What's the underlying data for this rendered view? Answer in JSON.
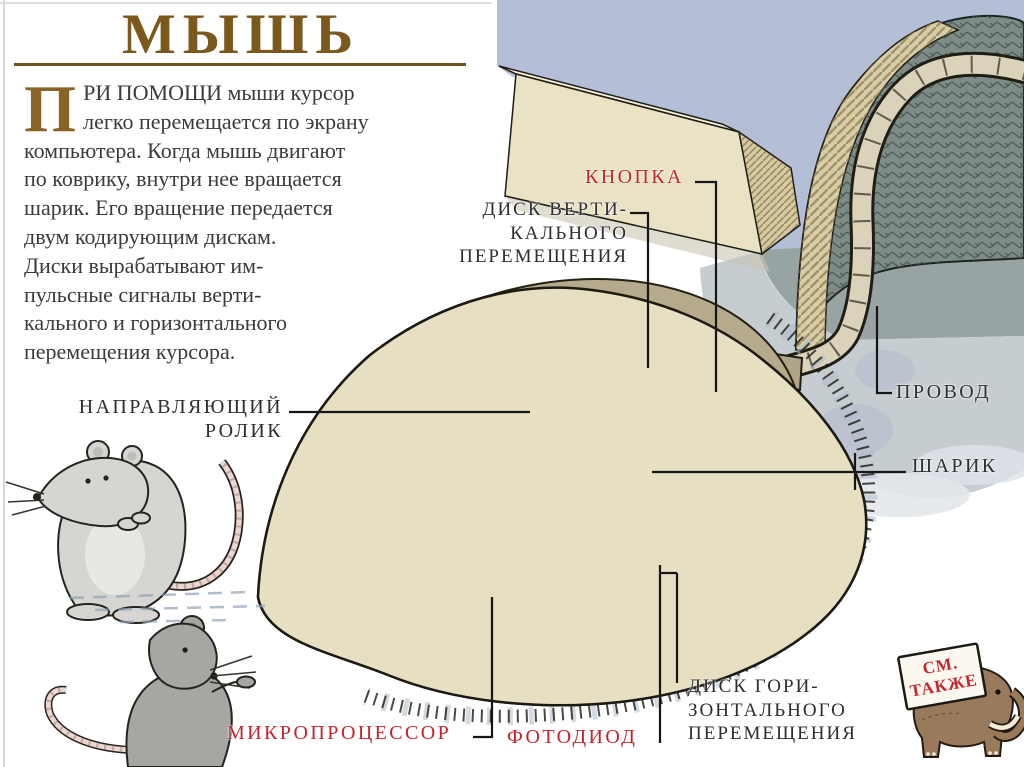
{
  "page": {
    "title": "МЫШЬ"
  },
  "intro": {
    "drop_cap": "П",
    "lines": [
      "РИ ПОМОЩИ мыши курсор",
      "легко перемещается по экрану",
      "компьютера. Когда мышь двигают",
      "по коврику, внутри нее вращается",
      "шарик. Его вращение передается",
      "двум кодирующим дискам.",
      "Диски вырабатывают им-",
      "пульсные сигналы верти-",
      "кального и горизонтального",
      "перемещения курсора."
    ]
  },
  "labels": {
    "button": "КНОПКА",
    "vertical_disk": [
      "ДИСК ВЕРТИ-",
      "КАЛЬНОГО",
      "ПЕРЕМЕЩЕНИЯ"
    ],
    "wire": "ПРОВОД",
    "ball": "ШАРИК",
    "guide_roller": [
      "НАПРАВЛЯЮЩИЙ",
      "РОЛИК"
    ],
    "microprocessor": "МИКРОПРОЦЕССОР",
    "photodiode": "ФОТОДИОД",
    "horizontal_disk": [
      "ДИСК ГОРИ-",
      "ЗОНТАЛЬНОГО",
      "ПЕРЕМЕЩЕНИЯ"
    ],
    "see_also": [
      "СМ.",
      "ТАКЖЕ"
    ]
  },
  "colors": {
    "accent_red": "#c5242b",
    "title_brown": "#7b591d",
    "text_dark": "#3b3b3b",
    "background_blue": "#b4bed7",
    "mouse_cream": "#e7dfc2",
    "pcb_green": "#a4ba98",
    "ball_gray": "#55544e",
    "disk_purple": "#958bc7"
  }
}
